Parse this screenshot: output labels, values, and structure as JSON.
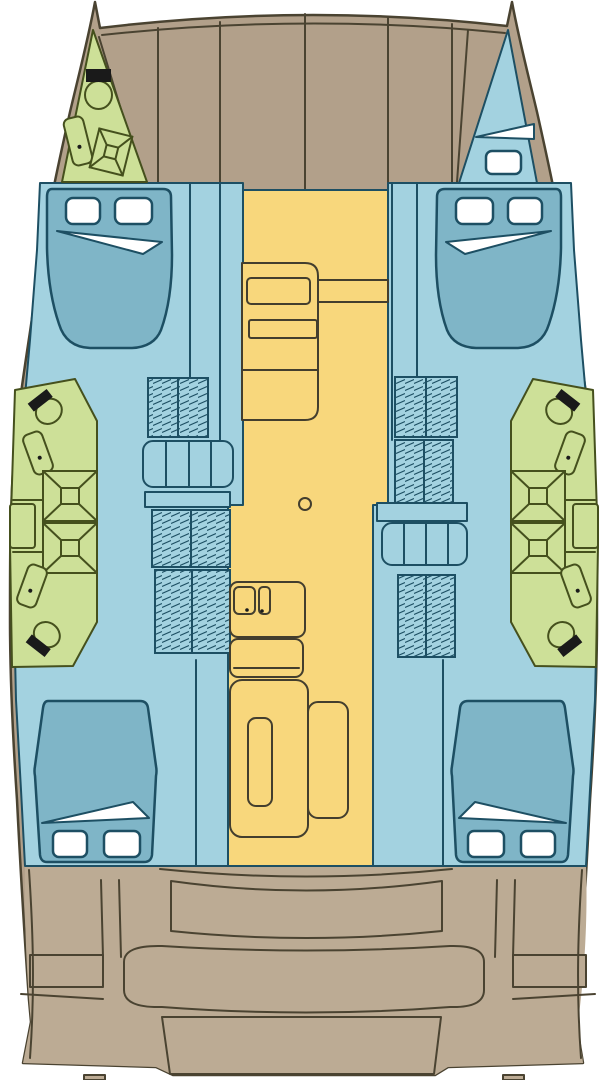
{
  "meta": {
    "title": "Catamaran yacht deck plan - top view floor layout",
    "diagram_type": "boat-floor-plan"
  },
  "palette": {
    "background": "#ffffff",
    "deck": "#b2a08a",
    "deck_aft": "#bcab94",
    "outline": "#4a4331",
    "hull_blue": "#a3d2e0",
    "bed_blue": "#7fb5c7",
    "blue_outline": "#1d4f63",
    "bathroom_green": "#cde098",
    "green_outline": "#45501d",
    "salon_yellow": "#f8d77c",
    "furniture_outline": "#433e2e",
    "black": "#1a1a1a"
  },
  "regions": {
    "foredeck": {
      "label": "foredeck",
      "color_key": "deck"
    },
    "bow_port_bathroom": {
      "label": "bow port bathroom",
      "color_key": "bathroom_green"
    },
    "bow_starboard_locker": {
      "label": "bow starboard locker",
      "color_key": "hull_blue"
    },
    "port_forward_cabin": {
      "label": "port forward cabin",
      "color_key": "hull_blue"
    },
    "starboard_forward_cabin": {
      "label": "starboard forward cabin",
      "color_key": "hull_blue"
    },
    "port_bathroom": {
      "label": "port midship bathroom",
      "color_key": "bathroom_green"
    },
    "starboard_bathroom": {
      "label": "starboard midship bathroom",
      "color_key": "bathroom_green"
    },
    "salon_galley": {
      "label": "salon and galley",
      "color_key": "salon_yellow"
    },
    "port_aft_cabin": {
      "label": "port aft cabin",
      "color_key": "hull_blue"
    },
    "starboard_aft_cabin": {
      "label": "starboard aft cabin",
      "color_key": "hull_blue"
    },
    "cockpit": {
      "label": "aft cockpit",
      "color_key": "deck_aft"
    },
    "transom": {
      "label": "transom platform",
      "color_key": "deck_aft"
    }
  },
  "inventory": {
    "double_beds": 4,
    "toilets": 5,
    "sinks": 5,
    "showers": 5,
    "hatch_windows": 9,
    "door_triangles": 5,
    "wardrobes_hatched": 6,
    "companionway_steps": 2,
    "mast_post": 1,
    "cockpit_benches": 2
  }
}
